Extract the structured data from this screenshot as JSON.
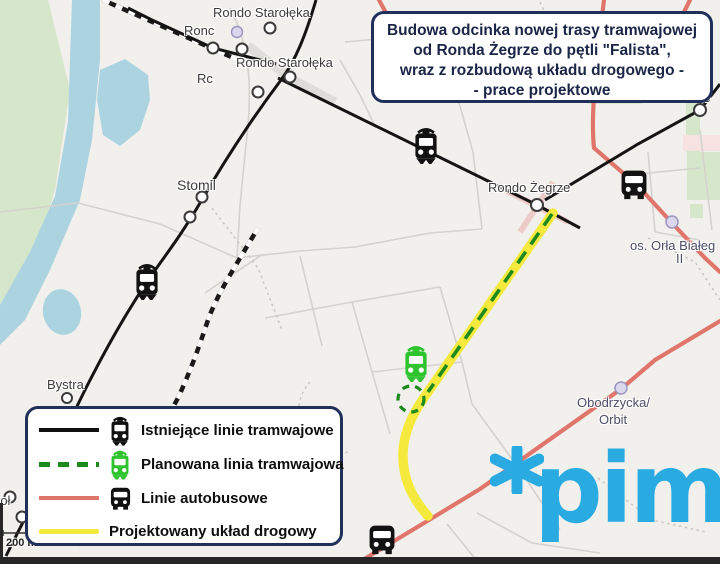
{
  "title_box": {
    "lines": [
      "Budowa odcinka nowej trasy tramwajowej",
      "od Ronda Żegrze do pętli \"Falista\",",
      "wraz z rozbudową układu drogowego -",
      "- prace projektowe"
    ]
  },
  "legend": {
    "items": [
      {
        "label": "Istniejące linie tramwajowe",
        "line_style": "solid-black",
        "icon": "tram-icon"
      },
      {
        "label": "Planowana linia tramwajowa",
        "line_style": "dashed-green",
        "icon": "tram-icon"
      },
      {
        "label": "Linie autobusowe",
        "line_style": "solid-salmon",
        "icon": "bus-icon"
      },
      {
        "label": "Projektowany układ drogowy",
        "line_style": "solid-yellow",
        "icon": null
      }
    ]
  },
  "map": {
    "labels": [
      {
        "text": "Rondo Starołęka"
      },
      {
        "text": "Ronc"
      },
      {
        "text": "Rondo Starołęka"
      },
      {
        "text": "Rc"
      },
      {
        "text": "Stomil"
      },
      {
        "text": "Rondo Żegrze"
      },
      {
        "text": "ze"
      },
      {
        "text": "os. Orła Białeg"
      },
      {
        "text": "II"
      },
      {
        "text": "Bystra"
      },
      {
        "text": "Obodrzycka/"
      },
      {
        "text": "Orbit"
      },
      {
        "text": "roł"
      }
    ],
    "scale_text": "200 m"
  },
  "logo": {
    "text": "pim"
  },
  "icons": {
    "tram_existing": "tram-icon (black)",
    "tram_planned": "tram-icon (green)",
    "bus": "bus-icon (black)",
    "logo_star": "asterisk-icon"
  },
  "colors": {
    "planned_road_yellow": "#f5e93e",
    "planned_tram_green_dash": "#1d8a1d",
    "planned_tram_icon_green": "#2ec42e",
    "bus_line_salmon": "#e0766b",
    "existing_tram_black": "#141414",
    "panel_border_navy": "#20305a",
    "logo_blue": "#29abe2",
    "water_blue": "#abd4e0",
    "park_green": "#d5e6cb"
  }
}
